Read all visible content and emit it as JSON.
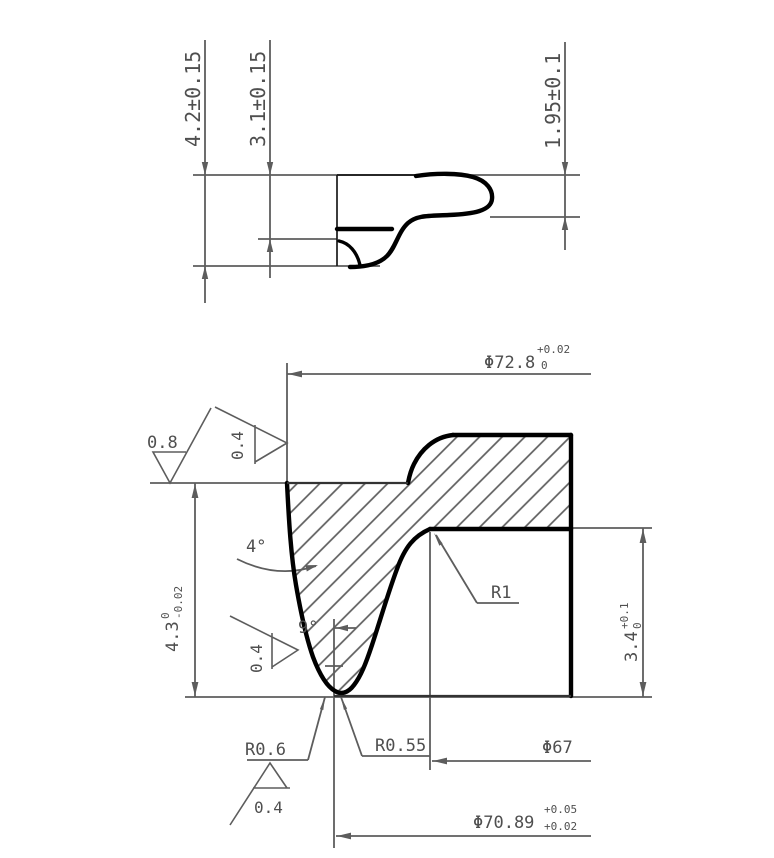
{
  "drawing": {
    "top_view": {
      "dim_height_42": "4.2±0.15",
      "dim_height_31": "3.1±0.15",
      "dim_height_195": "1.95±0.1"
    },
    "bottom_view": {
      "dia_728_label": "Φ72.8",
      "dia_728_upper": "+0.02",
      "dia_728_lower": "0",
      "roughness_outer": "0.8",
      "roughness_od": "0.4",
      "roughness_flank": "0.4",
      "roughness_groove": "0.4",
      "angle_taper": "4°",
      "angle_flank": "9°",
      "dim_43_label": "4.3",
      "dim_43_upper": "0",
      "dim_43_lower": "-0.02",
      "radius_r1": "R1",
      "dim_34_label": "3.4",
      "dim_34_upper": "+0.1",
      "dim_34_lower": "0",
      "radius_r06": "R0.6",
      "radius_r055": "R0.55",
      "dia_67": "Φ67",
      "dia_7089_label": "Φ70.89",
      "dia_7089_upper": "+0.05",
      "dia_7089_lower": "+0.02"
    },
    "colors": {
      "line": "#5d5d5d",
      "profile": "#000000",
      "text": "#4f4f4f",
      "background": "#ffffff"
    }
  }
}
